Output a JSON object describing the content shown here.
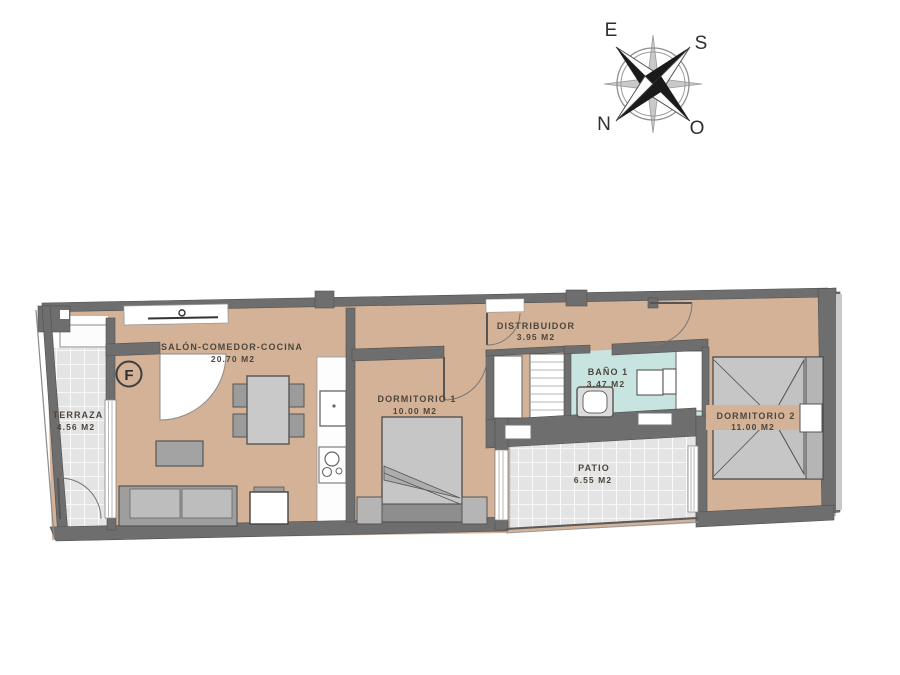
{
  "title": "Apartment floor plan",
  "unit": {
    "label": "F"
  },
  "compass": {
    "e": "E",
    "s": "S",
    "n": "N",
    "o": "O"
  },
  "rooms": {
    "terraza": {
      "name": "TERRAZA",
      "area": "4.56 M2"
    },
    "salon": {
      "name": "SALÓN-COMEDOR-COCINA",
      "area": "20.70 M2"
    },
    "dormitorio1": {
      "name": "DORMITORIO 1",
      "area": "10.00 M2"
    },
    "distribuidor": {
      "name": "DISTRIBUIDOR",
      "area": "3.95 M2"
    },
    "bano1": {
      "name": "BAÑO 1",
      "area": "3.47 M2"
    },
    "dormitorio2": {
      "name": "DORMITORIO 2",
      "area": "11.00 M2"
    },
    "patio": {
      "name": "PATIO",
      "area": "6.55 M2"
    }
  },
  "colors": {
    "floor_tan": "#d3b298",
    "tile_gray": "#e4e4e4",
    "bath_teal": "#c7e4e0",
    "wall_gray": "#6e6e6e",
    "label_ink": "#4d463c"
  }
}
